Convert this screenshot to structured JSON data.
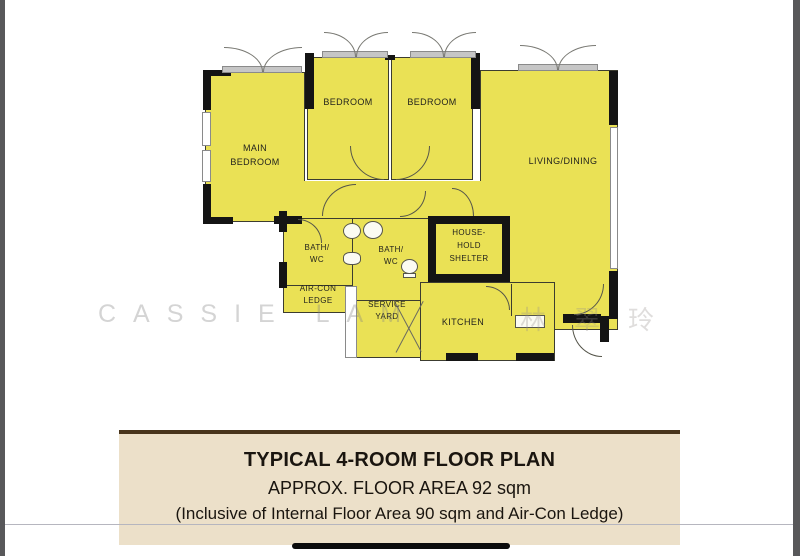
{
  "plan": {
    "labels": {
      "main_bedroom_l1": "MAIN",
      "main_bedroom_l2": "BEDROOM",
      "bedroom_left": "BEDROOM",
      "bedroom_right": "BEDROOM",
      "living_dining": "LIVING/DINING",
      "bath_left_l1": "BATH/",
      "bath_left_l2": "WC",
      "bath_right_l1": "BATH/",
      "bath_right_l2": "WC",
      "shelter_l1": "HOUSE-",
      "shelter_l2": "HOLD",
      "shelter_l3": "SHELTER",
      "aircon_l1": "AIR-CON",
      "aircon_l2": "LEDGE",
      "service_l1": "SERVICE",
      "service_l2": "YARD",
      "kitchen": "KITCHEN"
    },
    "colors": {
      "room_fill": "#eae155",
      "wall": "#141414"
    }
  },
  "watermark": {
    "name_latin": "CASSIE LAM",
    "name_cjk": "林翠玲"
  },
  "caption": {
    "title": "TYPICAL 4-ROOM FLOOR PLAN",
    "subtitle": "APPROX. FLOOR AREA 92 sqm",
    "note": "(Inclusive of Internal Floor Area 90 sqm and Air-Con Ledge)"
  }
}
